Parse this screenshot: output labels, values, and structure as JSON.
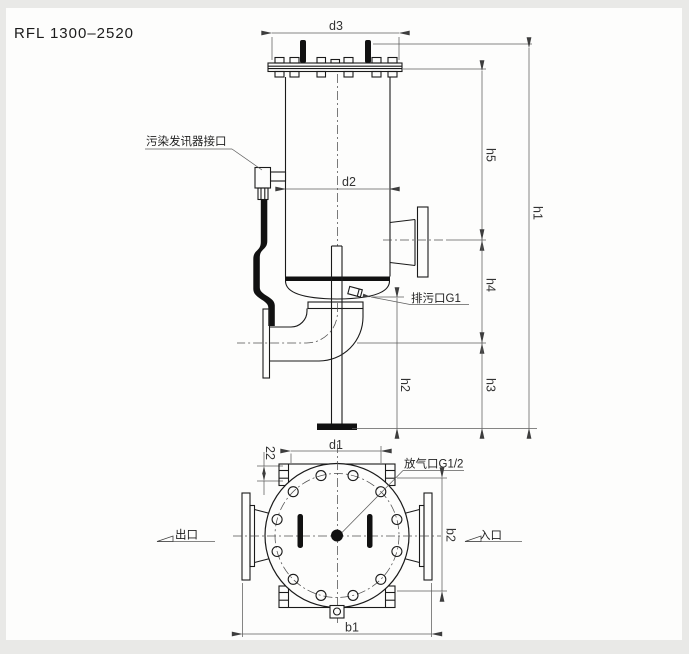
{
  "title": "RFL 1300–2520",
  "front_view": {
    "pollution_port_label": "污染发讯器接口",
    "drain_port_label": "排污口G1",
    "dim_d3": "d3",
    "dim_d2": "d2",
    "dim_h1": "h1",
    "dim_h2": "h2",
    "dim_h3": "h3",
    "dim_h4": "h4",
    "dim_h5": "h5"
  },
  "plan_view": {
    "vent_port_label": "放气口G1/2",
    "outlet_label": "出口",
    "inlet_label": "入口",
    "dim_d1": "d1",
    "dim_b1": "b1",
    "dim_b2": "b2",
    "dim_pad_width": "22"
  },
  "colors": {
    "line": "#1a1a1a",
    "dimension": "#4a4a4a",
    "paper": "#fdfdfc",
    "frame": "#e9e9e7"
  }
}
